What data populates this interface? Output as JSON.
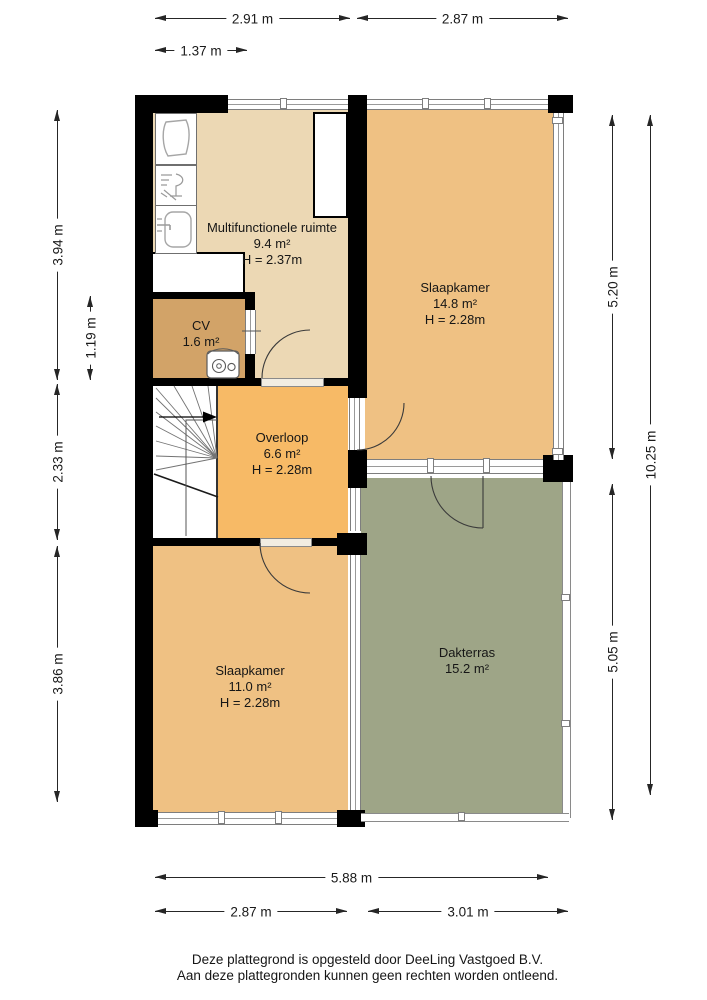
{
  "page": {
    "footer_line1": "Deze plattegrond is opgesteld door DeeLing Vastgoed B.V.",
    "footer_line2": "Aan deze plattegronden kunnen geen rechten worden ontleend."
  },
  "rooms": {
    "multifunctionele_ruimte": {
      "name": "Multifunctionele ruimte",
      "area": "9.4 m²",
      "height": "H = 2.37m"
    },
    "slaapkamer_boven": {
      "name": "Slaapkamer",
      "area": "14.8 m²",
      "height": "H = 2.28m"
    },
    "cv": {
      "name": "CV",
      "area": "1.6 m²"
    },
    "overloop": {
      "name": "Overloop",
      "area": "6.6 m²",
      "height": "H = 2.28m"
    },
    "slaapkamer_onder": {
      "name": "Slaapkamer",
      "area": "11.0 m²",
      "height": "H = 2.28m"
    },
    "dakterras": {
      "name": "Dakterras",
      "area": "15.2 m²"
    }
  },
  "dimensions": {
    "top": {
      "d1": "2.91 m",
      "d2": "2.87 m",
      "d3": "1.37 m"
    },
    "left": {
      "d1": "3.94 m",
      "d2": "1.19 m",
      "d3": "2.33 m",
      "d4": "3.86 m"
    },
    "right": {
      "d1": "5.20 m",
      "d2": "10.25 m",
      "d3": "5.05 m"
    },
    "bottom": {
      "d1": "5.88 m",
      "d2": "2.87 m",
      "d3": "3.01 m"
    }
  },
  "fixtures": [
    "basin-icon",
    "dishwasher-icon",
    "sink-icon",
    "cv-boiler-icon",
    "staircase-icon",
    "door-swing-arc"
  ],
  "colors": {
    "wall": "#000000",
    "room_multifunctioneel": "#ecd8b4",
    "room_slaapkamer": "#efc183",
    "room_cv": "#d2a368",
    "room_overloop": "#f7ba66",
    "room_dakterras": "#9ea587",
    "dimension_lines": "#262626"
  }
}
